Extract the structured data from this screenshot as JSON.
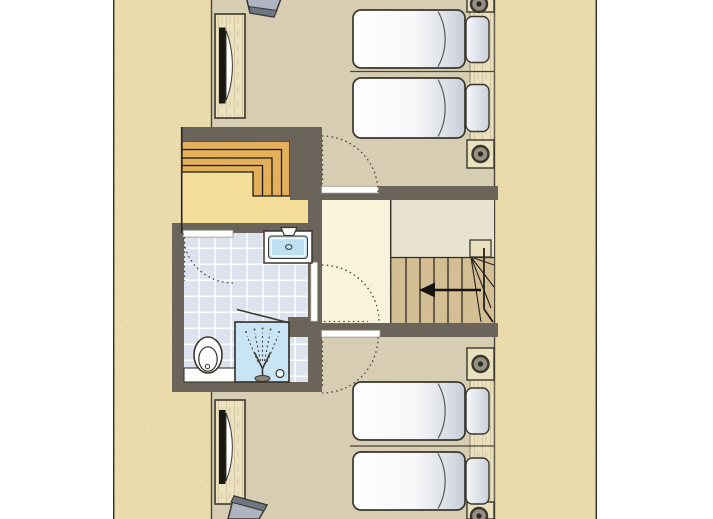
{
  "canvas": {
    "width": 713,
    "height": 519
  },
  "colors": {
    "page_bg": "#ffffff",
    "sand_base": "#f1e3b5",
    "wall": "#6b645b",
    "outline": "#39362e",
    "thin_line": "#4a4438",
    "bedroom_floor": "#d7cdb3",
    "hall_floor": "#faf3dc",
    "landing_floor": "#e8e3d1",
    "landing_yellow": "#f5dd9a",
    "stair_orange": "#e7b158",
    "stair_wood": "#d5bf95",
    "wood_light": "#ebe1bf",
    "wood_edge": "#8a8270",
    "tile": "#dce3ee",
    "grout": "#ffffff",
    "shower_blue": "#c9e4f5",
    "fixture_blue": "#bfdff2",
    "mattress_light": "#ffffff",
    "mattress_shade": "#c6ccd7",
    "pillow_light": "#f7f8fa",
    "pillow_shade": "#c9cfda",
    "chair_light": "#aeb4c0",
    "chair_dark": "#6e7684",
    "tv_black": "#1a1813",
    "door_white": "#ffffff",
    "arc_dots": "#4c473e",
    "arrow_black": "#15130f",
    "glass_gray": "#8a8478",
    "drain_fill": "#eaf4fb",
    "border_line": "#2e2b25"
  },
  "floorplan": {
    "type": "floor-plan",
    "bed_count": 4,
    "door_count": 4,
    "stair_count": 2,
    "rooms": [
      {
        "name": "bedroom-top",
        "items": [
          "chair",
          "tv-dresser",
          "single-bed",
          "single-bed",
          "headboard-panel",
          "wall-lamp",
          "wall-lamp"
        ]
      },
      {
        "name": "hall",
        "items": [
          "door-to-bedroom-top",
          "door-to-bathroom",
          "door-to-bedroom-bottom",
          "stair-opening"
        ]
      },
      {
        "name": "bathroom",
        "items": [
          "washbasin",
          "toilet",
          "counter",
          "shower",
          "tiled-floor",
          "door-swing"
        ]
      },
      {
        "name": "attic-stairs",
        "items": [
          "winder-steps",
          "yellow-landing"
        ]
      },
      {
        "name": "main-staircase",
        "items": [
          "treads",
          "winder-corner",
          "newel-post",
          "direction-arrow",
          "landing"
        ]
      },
      {
        "name": "bedroom-bottom",
        "items": [
          "single-bed",
          "single-bed",
          "headboard-panel",
          "wall-lamp",
          "wall-lamp",
          "tv-dresser",
          "chair"
        ]
      }
    ]
  }
}
